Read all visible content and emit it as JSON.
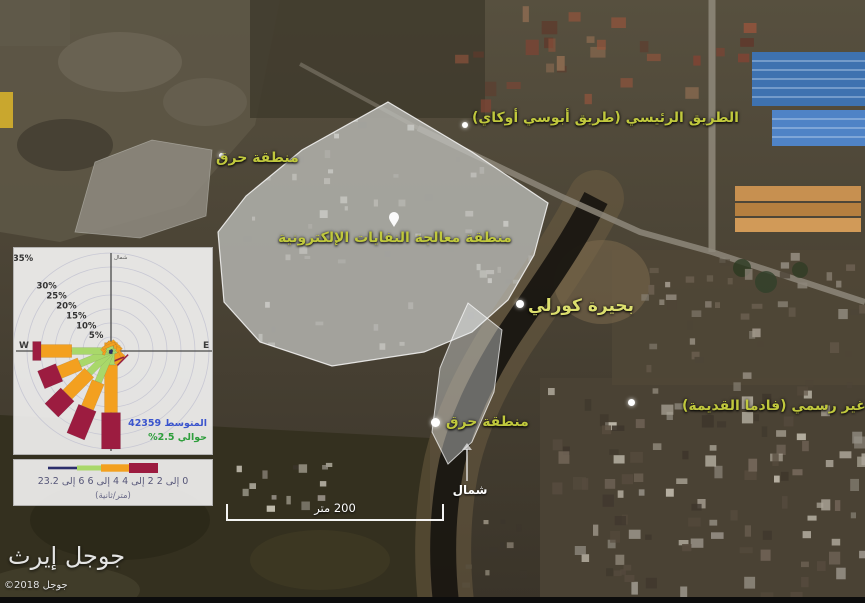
{
  "watermark": {
    "title": "جوجل إيرث",
    "copyright": "©2018 جوجل"
  },
  "map_labels": {
    "road": {
      "text": "الطريق الرئيسي (طريق أبوسي أوكاي)"
    },
    "burn_area_north": {
      "text": "منطقة حرق"
    },
    "ewaste_area": {
      "text": "منطقة معالجة النفايات الإلكترونية"
    },
    "lagoon": {
      "text": "بحيرة كورلي"
    },
    "burn_area_south": {
      "text": "منطقة حرق"
    },
    "informal_community": {
      "text": "مجتمع غير رسمي (فادما القديمة)"
    },
    "north_label": {
      "text": "شمال"
    },
    "scale_bar": {
      "text": "200 متر"
    }
  },
  "chart_data": {
    "type": "wind_rose",
    "legend_position": "below plot, bottom-left overlay panel",
    "grid": true,
    "rings_pct": [
      5,
      10,
      15,
      20,
      25,
      30,
      35
    ],
    "axis_labels": {
      "west": "W",
      "east": "E",
      "north": "شمال"
    },
    "mean_label": "المتوسط 42359",
    "calm_label": "حوالي 2.5%",
    "legend_text": "0 إلى 2 2 إلى 4 4 إلى 6 6 إلى 23.2",
    "unit_label": "(متر/ثانية)",
    "speed_bins": [
      {
        "range": "0 إلى 2",
        "color": "#2b2e6b"
      },
      {
        "range": "2 إلى 4",
        "color": "#a9d86a"
      },
      {
        "range": "4 إلى 6",
        "color": "#f3a01f"
      },
      {
        "range": "6 إلى 23.2",
        "color": "#9c1c40"
      }
    ],
    "directions": [
      "N",
      "NNE",
      "NE",
      "ENE",
      "E",
      "ESE",
      "SE",
      "SSE",
      "S",
      "SSW",
      "SW",
      "WSW",
      "W",
      "WNW",
      "NW",
      "NNW"
    ],
    "petals_pct_by_bin": [
      [
        0.5,
        0.5,
        0.5,
        0.5,
        0.5,
        0.5,
        0.5,
        0.5,
        1,
        1,
        1,
        1,
        1,
        0.5,
        0.5,
        0.5
      ],
      [
        1,
        1,
        1,
        1,
        0.5,
        1,
        1.5,
        1,
        4,
        11,
        10,
        11,
        13,
        1,
        1,
        1
      ],
      [
        1.5,
        1.5,
        2,
        1,
        1,
        1.5,
        3,
        2,
        17,
        10,
        11,
        8,
        11,
        1,
        1.5,
        1
      ],
      [
        0,
        0,
        0,
        0,
        0,
        0,
        0.5,
        0.5,
        13,
        11,
        8,
        7,
        3,
        0,
        0,
        0
      ]
    ]
  },
  "colors": {
    "annotation_yellow": "#c0c83d",
    "overlay_white": "rgba(234,238,243,0.42)",
    "mean_blue": "#3b55cd",
    "calm_green": "#2e9e3c"
  }
}
